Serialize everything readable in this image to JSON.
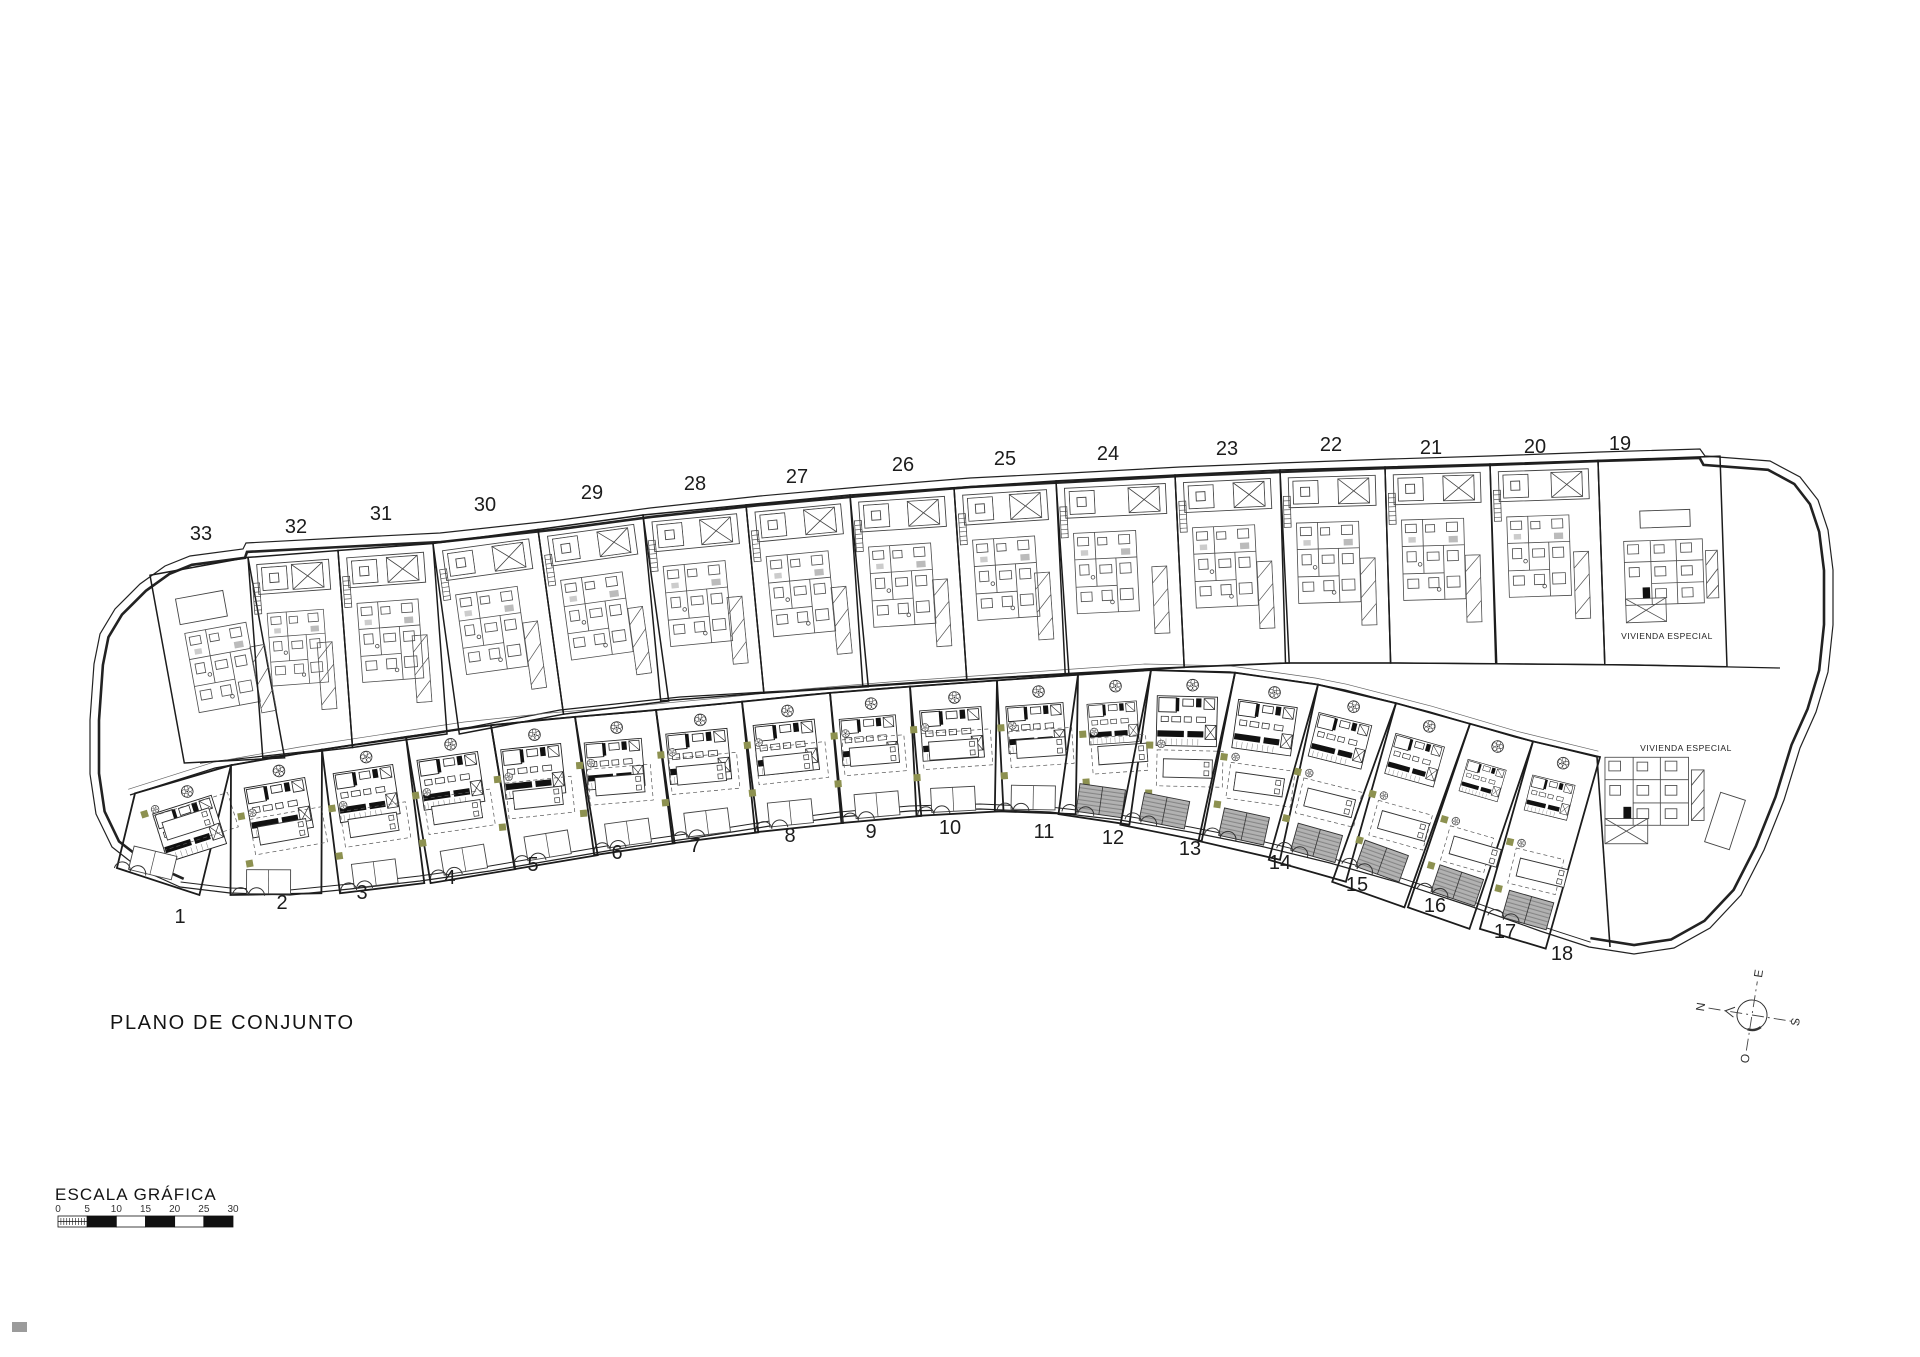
{
  "title": {
    "text": "PLANO DE CONJUNTO"
  },
  "scale_bar": {
    "label": "ESCALA GRÁFICA",
    "ticks": [
      "0",
      "5",
      "10",
      "15",
      "20",
      "25",
      "30"
    ]
  },
  "compass": {
    "north": "N",
    "south": "S",
    "east": "E",
    "west": "O"
  },
  "special_parcels": [
    {
      "label": "VIVIENDA ESPECIAL"
    },
    {
      "label": "VIVIENDA ESPECIAL"
    }
  ],
  "plots": {
    "top_row": [
      {
        "number": "33",
        "x": 201,
        "y": 533
      },
      {
        "number": "32",
        "x": 296,
        "y": 526
      },
      {
        "number": "31",
        "x": 381,
        "y": 513
      },
      {
        "number": "30",
        "x": 485,
        "y": 504
      },
      {
        "number": "29",
        "x": 592,
        "y": 492
      },
      {
        "number": "28",
        "x": 695,
        "y": 483
      },
      {
        "number": "27",
        "x": 797,
        "y": 476
      },
      {
        "number": "26",
        "x": 903,
        "y": 464
      },
      {
        "number": "25",
        "x": 1005,
        "y": 458
      },
      {
        "number": "24",
        "x": 1108,
        "y": 453
      },
      {
        "number": "23",
        "x": 1227,
        "y": 448
      },
      {
        "number": "22",
        "x": 1331,
        "y": 444
      },
      {
        "number": "21",
        "x": 1431,
        "y": 447
      },
      {
        "number": "20",
        "x": 1535,
        "y": 446
      },
      {
        "number": "19",
        "x": 1620,
        "y": 443
      }
    ],
    "bottom_row": [
      {
        "number": "1",
        "x": 180,
        "y": 916
      },
      {
        "number": "2",
        "x": 282,
        "y": 902
      },
      {
        "number": "3",
        "x": 362,
        "y": 892
      },
      {
        "number": "4",
        "x": 450,
        "y": 877
      },
      {
        "number": "5",
        "x": 533,
        "y": 864
      },
      {
        "number": "6",
        "x": 617,
        "y": 852
      },
      {
        "number": "7",
        "x": 695,
        "y": 845
      },
      {
        "number": "8",
        "x": 790,
        "y": 835
      },
      {
        "number": "9",
        "x": 871,
        "y": 831
      },
      {
        "number": "10",
        "x": 950,
        "y": 827
      },
      {
        "number": "11",
        "x": 1044,
        "y": 831
      },
      {
        "number": "12",
        "x": 1113,
        "y": 837
      },
      {
        "number": "13",
        "x": 1190,
        "y": 848
      },
      {
        "number": "14",
        "x": 1280,
        "y": 862
      },
      {
        "number": "15",
        "x": 1357,
        "y": 884
      },
      {
        "number": "16",
        "x": 1435,
        "y": 905
      },
      {
        "number": "17",
        "x": 1505,
        "y": 931
      },
      {
        "number": "18",
        "x": 1562,
        "y": 953
      }
    ]
  },
  "colors": {
    "ink": "#1c1c1c",
    "light_ink": "#555555",
    "boundary": "#222222",
    "driveway_gray": "#b2b2b2",
    "driveway_line": "#868686",
    "olive": "#8d9150"
  }
}
